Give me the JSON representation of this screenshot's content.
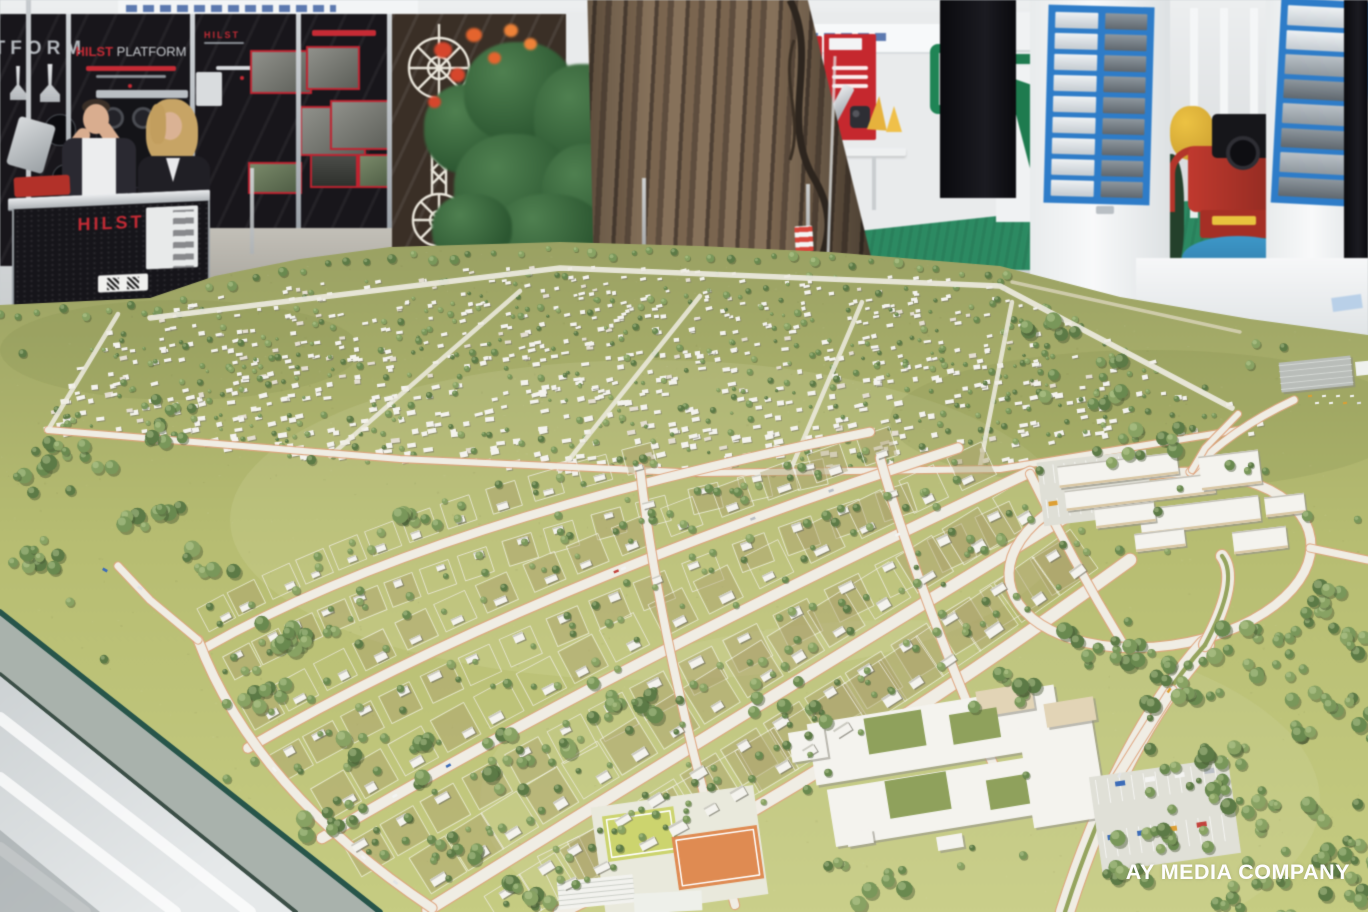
{
  "photo": {
    "watermark": "AY MEDIA COMPANY",
    "subject": "architectural-scale-model-of-residential-district",
    "setting": "indoor-exhibition-hall"
  },
  "exhibition": {
    "hilst": {
      "brand": "HILST",
      "suffix": "PLATFORM",
      "counter_label": "HILST",
      "accent": "#c62b35",
      "wall_color": "#18161b"
    },
    "right_booth": {
      "banner_red": "#c5282e"
    },
    "carpet_green": "#2c8a62",
    "display_blue": "#2e7cc8",
    "machine_red": "#c0392e",
    "machine_base_blue": "#3d97c8",
    "booth3_green": "#1e7b4f"
  },
  "model": {
    "colors": {
      "terrain_far": "#9aa163",
      "terrain_mid": "#b7bd72",
      "terrain_near": "#c6cc82",
      "road": "#f0ede4",
      "curb": "#dfa57f",
      "house": "#f4f3ee",
      "house_shadow": "#a9a89c",
      "tree_palette": [
        "#5c7a46",
        "#69894f",
        "#79975a",
        "#88a263"
      ],
      "tree_shadow": "rgba(70,86,52,0.45)",
      "court_orange": "#df8b52",
      "court_green": "#ccd46e",
      "courtyard_green": "#8fa15c",
      "warehouse_gray": "#b9bdb9",
      "median_green": "#95a45e",
      "glass_edge": "#27554a",
      "glass_face": "#a9b2ac",
      "base_silver": "#e6e9ea"
    },
    "features": [
      "dense-housing-district",
      "curved-villa-streets",
      "town-center-complex",
      "school-campus",
      "sports-courts",
      "warehouse",
      "tree-park",
      "boulevard-with-median"
    ],
    "render": {
      "seed": 73,
      "dense_houses": 820,
      "dense_trees": 430,
      "scatter_trees": 70
    }
  }
}
